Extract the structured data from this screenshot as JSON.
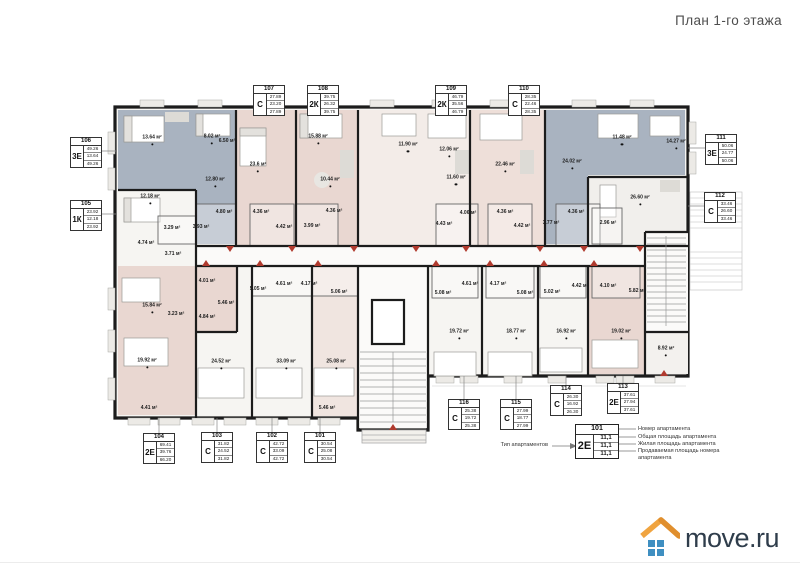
{
  "title": "План 1-го этажа",
  "logo": {
    "text": "move.ru",
    "roof_color": "#f0a440",
    "roof_shade": "#e08f2e",
    "window_color": "#3f8fc1",
    "text_color": "#2f3d4b"
  },
  "palette": {
    "wall": "#1c1c1c",
    "unit_blue": "#a9b3c0",
    "unit_pink": "#e9d7d1",
    "unit_pink_light": "#eedfd9",
    "unit_pale": "#f3ece8",
    "floor": "#f6f5f2",
    "door_red": "#b03a2e"
  },
  "legend": {
    "type_label": "Тип апартаментов",
    "sample_number": "101",
    "sample_type": "2Е",
    "sample_values": [
      "11,1",
      "11,1",
      "11,1"
    ],
    "lines": [
      "Номер апартамента",
      "Общая площадь апартамента",
      "Жилая площадь апартамента",
      "Продаваемая площадь номера апартамента"
    ]
  },
  "apartments": [
    {
      "number": "101",
      "type": "С",
      "values": [
        "30.54",
        "25.08",
        "30.54"
      ],
      "x": 304,
      "y": 432
    },
    {
      "number": "102",
      "type": "С",
      "values": [
        "42.72",
        "33.09",
        "42.72"
      ],
      "x": 256,
      "y": 432
    },
    {
      "number": "103",
      "type": "С",
      "values": [
        "31.82",
        "24.52",
        "31.82"
      ],
      "x": 201,
      "y": 432
    },
    {
      "number": "104",
      "type": "2Е",
      "values": [
        "69.41",
        "39.76",
        "66.20"
      ],
      "x": 143,
      "y": 433
    },
    {
      "number": "105",
      "type": "1К",
      "values": [
        "23.92",
        "12.18",
        "23.92"
      ],
      "x": 70,
      "y": 200
    },
    {
      "number": "106",
      "type": "3Е",
      "values": [
        "49.26",
        "13.64",
        "49.26"
      ],
      "x": 70,
      "y": 137
    },
    {
      "number": "107",
      "type": "С",
      "values": [
        "27.89",
        "23.20",
        "27.89"
      ],
      "x": 253,
      "y": 85
    },
    {
      "number": "108",
      "type": "2К",
      "values": [
        "39.75",
        "26.32",
        "39.75"
      ],
      "x": 307,
      "y": 85
    },
    {
      "number": "109",
      "type": "2К",
      "values": [
        "46.79",
        "35.56",
        "46.79"
      ],
      "x": 435,
      "y": 85
    },
    {
      "number": "110",
      "type": "С",
      "values": [
        "28.35",
        "22.46",
        "28.35"
      ],
      "x": 508,
      "y": 85
    },
    {
      "number": "111",
      "type": "3Е",
      "values": [
        "50.06",
        "24.77",
        "50.06"
      ],
      "x": 705,
      "y": 134
    },
    {
      "number": "112",
      "type": "С",
      "values": [
        "33.46",
        "26.60",
        "33.46"
      ],
      "x": 704,
      "y": 192
    },
    {
      "number": "113",
      "type": "2Е",
      "values": [
        "37.61",
        "27.94",
        "37.61"
      ],
      "x": 607,
      "y": 383
    },
    {
      "number": "114",
      "type": "С",
      "values": [
        "26.30",
        "16.92",
        "26.30"
      ],
      "x": 550,
      "y": 385
    },
    {
      "number": "115",
      "type": "С",
      "values": [
        "27.99",
        "18.77",
        "27.99"
      ],
      "x": 500,
      "y": 399
    },
    {
      "number": "116",
      "type": "С",
      "values": [
        "25.38",
        "19.72",
        "25.38"
      ],
      "x": 448,
      "y": 399
    }
  ],
  "rooms": [
    {
      "t": "13.64 м²",
      "x": 152,
      "y": 140
    },
    {
      "t": "8.02 м²",
      "x": 212,
      "y": 139
    },
    {
      "t": "6.50 м²",
      "x": 227,
      "y": 141
    },
    {
      "t": "12.80 м²",
      "x": 215,
      "y": 182
    },
    {
      "t": "3.93 м²",
      "x": 201,
      "y": 227
    },
    {
      "t": "4.80 м²",
      "x": 224,
      "y": 212
    },
    {
      "t": "12.18 м²",
      "x": 150,
      "y": 199
    },
    {
      "t": "3.29 м²",
      "x": 172,
      "y": 228
    },
    {
      "t": "4.74 м²",
      "x": 146,
      "y": 243
    },
    {
      "t": "3.71 м²",
      "x": 173,
      "y": 254
    },
    {
      "t": "23.6 м²",
      "x": 258,
      "y": 167
    },
    {
      "t": "4.36 м²",
      "x": 261,
      "y": 212
    },
    {
      "t": "4.42 м²",
      "x": 284,
      "y": 227
    },
    {
      "t": "15.88 м²",
      "x": 318,
      "y": 139
    },
    {
      "t": "10.44 м²",
      "x": 330,
      "y": 182
    },
    {
      "t": "3.99 м²",
      "x": 312,
      "y": 226
    },
    {
      "t": "4.36 м²",
      "x": 334,
      "y": 211
    },
    {
      "t": "11.90 м²",
      "x": 408,
      "y": 147
    },
    {
      "t": "12.06 м²",
      "x": 449,
      "y": 152
    },
    {
      "t": "11.60 м²",
      "x": 456,
      "y": 180
    },
    {
      "t": "4.06 м²",
      "x": 468,
      "y": 213
    },
    {
      "t": "4.43 м²",
      "x": 444,
      "y": 224
    },
    {
      "t": "22.46 м²",
      "x": 505,
      "y": 167
    },
    {
      "t": "4.36 м²",
      "x": 505,
      "y": 212
    },
    {
      "t": "4.42 м²",
      "x": 522,
      "y": 226
    },
    {
      "t": "11.48 м²",
      "x": 622,
      "y": 140
    },
    {
      "t": "14.27 м²",
      "x": 676,
      "y": 144
    },
    {
      "t": "24.02 м²",
      "x": 572,
      "y": 164
    },
    {
      "t": "3.77 м²",
      "x": 551,
      "y": 223
    },
    {
      "t": "4.36 м²",
      "x": 576,
      "y": 212
    },
    {
      "t": "26.60 м²",
      "x": 640,
      "y": 200
    },
    {
      "t": "2.96 м²",
      "x": 608,
      "y": 223
    },
    {
      "t": "15.84 м²",
      "x": 152,
      "y": 308
    },
    {
      "t": "3.23 м²",
      "x": 176,
      "y": 314
    },
    {
      "t": "19.92 м²",
      "x": 147,
      "y": 363
    },
    {
      "t": "4.41 м²",
      "x": 149,
      "y": 408
    },
    {
      "t": "4.01 м²",
      "x": 207,
      "y": 281
    },
    {
      "t": "4.84 м²",
      "x": 207,
      "y": 317
    },
    {
      "t": "5.46 м²",
      "x": 226,
      "y": 303
    },
    {
      "t": "24.52 м²",
      "x": 221,
      "y": 364
    },
    {
      "t": "5.05 м²",
      "x": 258,
      "y": 289
    },
    {
      "t": "4.61 м²",
      "x": 284,
      "y": 284
    },
    {
      "t": "33.09 м²",
      "x": 286,
      "y": 364
    },
    {
      "t": "4.17 м²",
      "x": 309,
      "y": 284
    },
    {
      "t": "5.06 м²",
      "x": 339,
      "y": 292
    },
    {
      "t": "25.08 м²",
      "x": 336,
      "y": 364
    },
    {
      "t": "5.46 м²",
      "x": 327,
      "y": 408
    },
    {
      "t": "5.08 м²",
      "x": 443,
      "y": 293
    },
    {
      "t": "4.61 м²",
      "x": 470,
      "y": 284
    },
    {
      "t": "19.72 м²",
      "x": 459,
      "y": 334
    },
    {
      "t": "4.17 м²",
      "x": 498,
      "y": 284
    },
    {
      "t": "5.08 м²",
      "x": 525,
      "y": 293
    },
    {
      "t": "18.77 м²",
      "x": 516,
      "y": 334
    },
    {
      "t": "5.02 м²",
      "x": 552,
      "y": 292
    },
    {
      "t": "4.42 м²",
      "x": 580,
      "y": 286
    },
    {
      "t": "16.92 м²",
      "x": 566,
      "y": 334
    },
    {
      "t": "4.10 м²",
      "x": 608,
      "y": 286
    },
    {
      "t": "5.82 м²",
      "x": 637,
      "y": 291
    },
    {
      "t": "19.02 м²",
      "x": 621,
      "y": 334
    },
    {
      "t": "8.92 м²",
      "x": 666,
      "y": 351
    }
  ]
}
